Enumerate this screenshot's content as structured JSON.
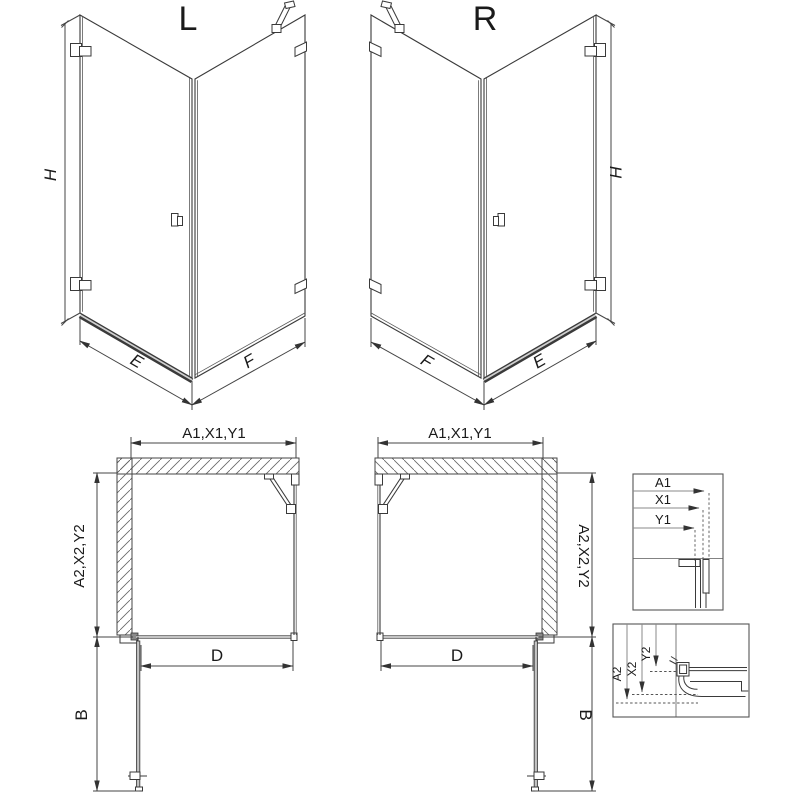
{
  "diagram_title": "Corner shower enclosure dimension drawing",
  "iso_views": [
    {
      "id": "left",
      "title": "L",
      "height_label": "H",
      "front_label": "E",
      "side_label": "F"
    },
    {
      "id": "right",
      "title": "R",
      "height_label": "H",
      "front_label": "E",
      "side_label": "F"
    }
  ],
  "plan_views": [
    {
      "id": "left",
      "top_label": "A1,X1,Y1",
      "side_label": "A2,X2,Y2",
      "door_label": "D",
      "swing_label": "B"
    },
    {
      "id": "right",
      "top_label": "A1,X1,Y1",
      "side_label": "A2,X2,Y2",
      "door_label": "D",
      "swing_label": "B"
    }
  ],
  "details": [
    {
      "id": "top-profile",
      "dims": [
        "A1",
        "X1",
        "Y1"
      ]
    },
    {
      "id": "bottom-profile",
      "dims": [
        "A2",
        "X2",
        "Y2"
      ]
    }
  ],
  "colors": {
    "background": "#ffffff",
    "line": "#3a3a3a",
    "gray_fill": "#c4c4c4",
    "hatch": "#666666"
  }
}
